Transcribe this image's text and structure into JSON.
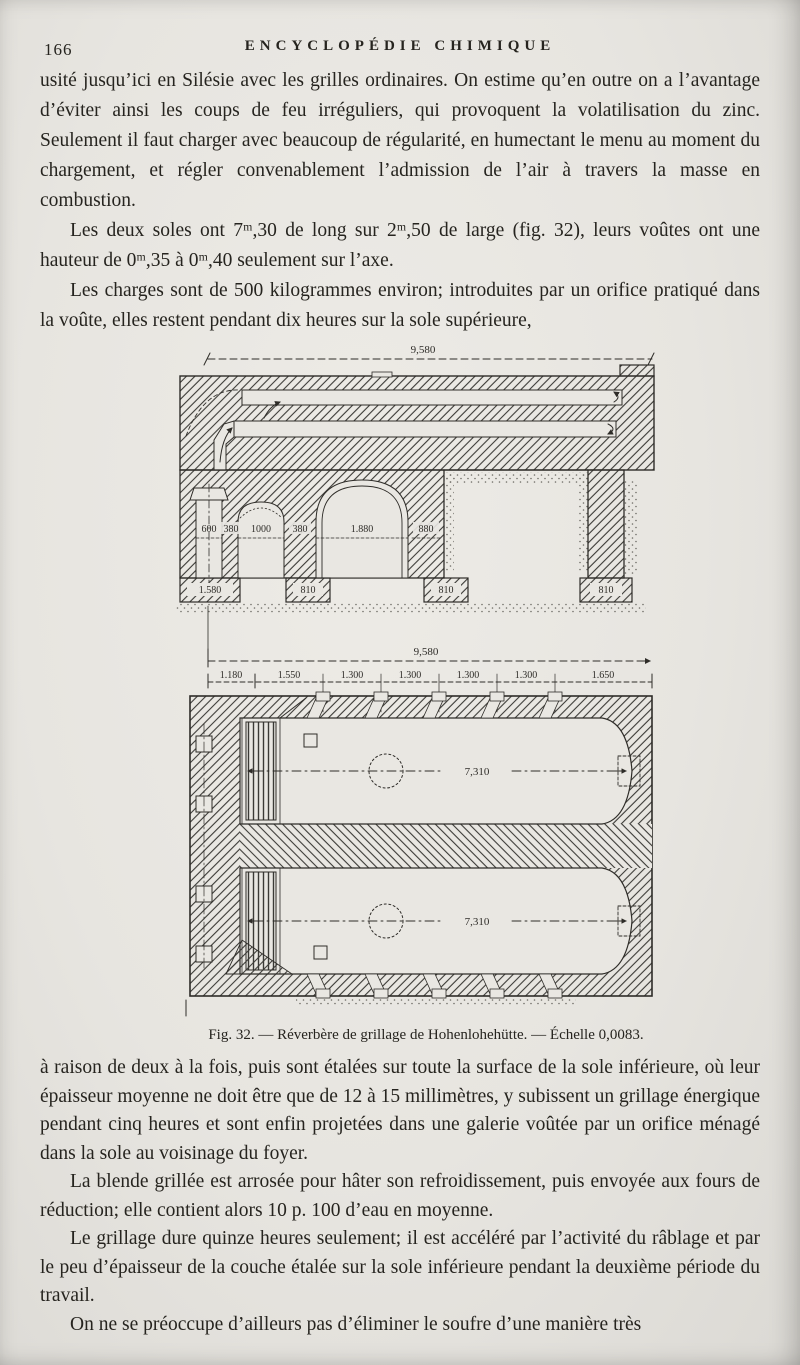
{
  "page": {
    "number": "166",
    "running_title": "ENCYCLOPÉDIE CHIMIQUE"
  },
  "content": {
    "paragraphs": [
      {
        "text": "usité jusqu’ici en Silésie avec les grilles ordinaires. On estime qu’en outre on a l’avantage d’éviter ainsi les coups de feu irréguliers, qui provoquent la volatilisation du zinc. Seulement il faut charger avec beaucoup de régularité, en humectant le menu au moment du chargement, et régler convenablement l’admission de l’air à travers la masse en combustion."
      },
      {
        "text": "Les deux soles ont 7ᵐ,30 de long sur 2ᵐ,50 de large (fig. 32), leurs voûtes ont une hauteur de 0ᵐ,35 à 0ᵐ,40 seulement sur l’axe."
      },
      {
        "text": "Les charges sont de 500 kilogrammes environ; introduites par un orifice pratiqué dans la voûte, elles restent pendant dix heures sur la sole supérieure,"
      },
      {
        "text": "à raison de deux à la fois, puis sont étalées sur toute la surface de la sole inférieure, où leur épaisseur moyenne ne doit être que de 12 à 15 millimètres, y subissent un grillage énergique pendant cinq heures et sont enfin projetées dans une galerie voûtée par un orifice ménagé dans la sole au voisinage du foyer."
      },
      {
        "text": "La blende grillée est arrosée pour hâter son refroidissement, puis envoyée aux fours de réduction; elle contient alors 10 p. 100 d’eau en moyenne."
      },
      {
        "text": "Le grillage dure quinze heures seulement; il est accéléré par l’activité du râblage et par le peu d’épaisseur de la couche étalée sur la sole inférieure pendant la deuxième période du travail."
      },
      {
        "text": "On ne se préoccupe d’ailleurs pas d’éliminer le soufre d’une manière très"
      }
    ]
  },
  "figure": {
    "caption": "Fig. 32. — Réverbère de grillage de Hohenlohehütte. — Échelle 0,0083.",
    "section_view": {
      "overall_dim": "9,580",
      "opening_dims": [
        "600",
        "380",
        "1000",
        "380",
        "1.880",
        "880"
      ],
      "footing_dims": [
        "1.580",
        "810",
        "810",
        "810"
      ]
    },
    "plan_view": {
      "overall_dim": "9,580",
      "segment_dims": [
        "1.180",
        "1.550",
        "1.300",
        "1.300",
        "1.300",
        "1.300",
        "1.650"
      ],
      "chamber_length_dim": "7,310"
    },
    "ink_color": "#2e2c28",
    "paper_color": "#e9e7e2"
  }
}
